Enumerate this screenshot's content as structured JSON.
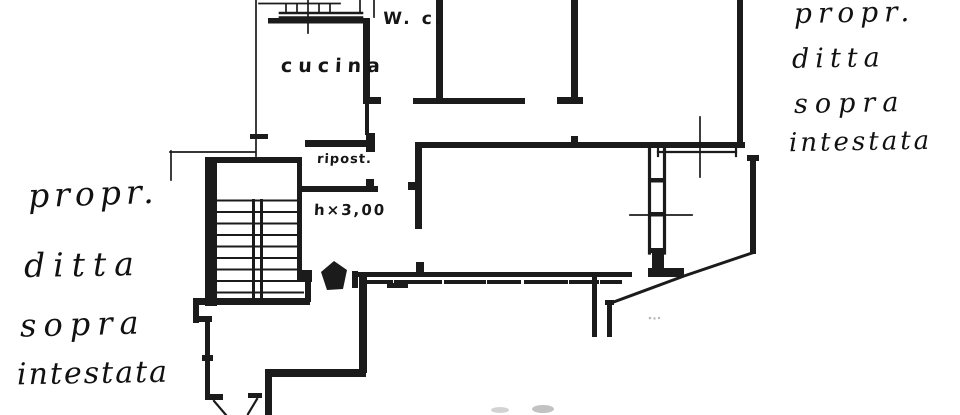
{
  "page": {
    "background": "#ffffff",
    "ink_color": "#1b1b1b"
  },
  "plan": {
    "room_labels": {
      "kitchen": "cucina",
      "wc": "W. c.",
      "storage": "ripost.",
      "ceiling_height": "h×3,00"
    },
    "ownership_note_left": {
      "lines": [
        "propr.",
        "ditta",
        "sopra",
        "intestata"
      ]
    },
    "ownership_note_right": {
      "lines": [
        "propr.",
        "ditta",
        "sopra",
        "intestata"
      ]
    }
  }
}
